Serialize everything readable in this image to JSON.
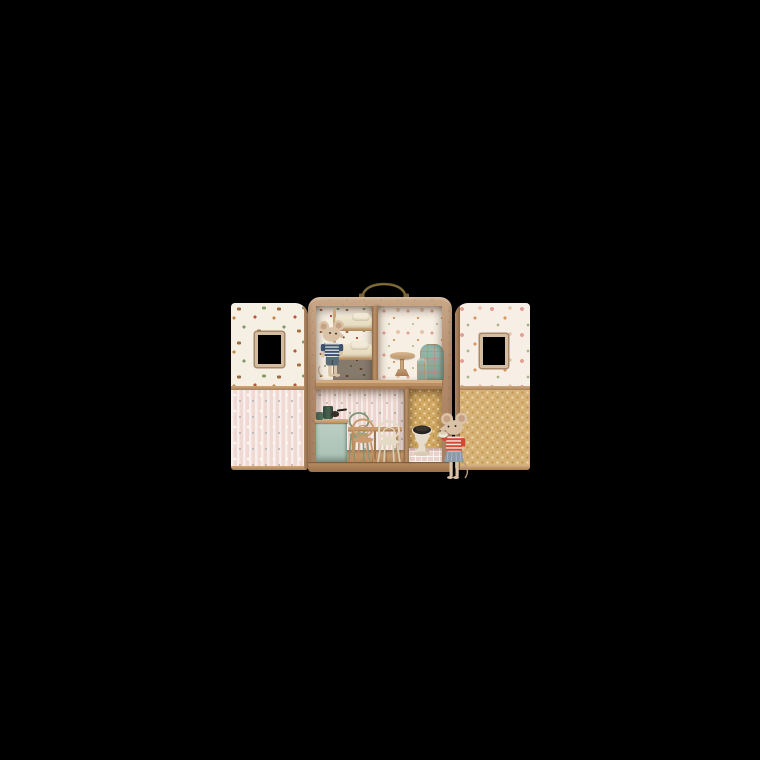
{
  "scene": {
    "description": "Product photograph of a toy mouse dollhouse built into an opened carry suitcase, shown on a plain black background. Two plush mice live in four wallpapered rooms furnished with miniature furniture.",
    "background_color": "#000000"
  },
  "product": {
    "name": "Mouse house suitcase dollhouse",
    "handle": "brass carry handle",
    "rooms": [
      {
        "name": "bedroom",
        "wallpaper": "cream western cowboy print",
        "furniture": [
          "bunk bed with cream mattresses and pillows"
        ],
        "occupant": "mouse in navy-and-white striped tee and blue-grey shorts"
      },
      {
        "name": "living-room",
        "wallpaper": "cream rose floral print",
        "furniture": [
          "round wooden pedestal table",
          "teal windowpane-check armchair"
        ]
      },
      {
        "name": "kitchen",
        "wallpaper": "pale pink pinstripe print",
        "furniture": [
          "mint kitchen cupboard with wooden counter",
          "dark green coffee pot",
          "green mug",
          "black pan",
          "wooden dining table",
          "green bentwood chair",
          "natural wood bentwood chair",
          "cream bentwood chair"
        ]
      },
      {
        "name": "bathroom",
        "wallpaper": "mustard damask print",
        "furniture": [
          "cream toilet with black seat",
          "pink tiled floor"
        ],
        "occupant": "mouse in red-and-white striped top and denim skirt holding a cream bowl"
      }
    ],
    "doors": [
      {
        "side": "left",
        "upper_wallpaper": "cream western cowboy print",
        "lower_wallpaper": "pink striped floral print",
        "window": "rectangular cut-out window with wooden frame"
      },
      {
        "side": "right",
        "upper_wallpaper": "cream rose floral print",
        "lower_wallpaper": "mustard damask print",
        "window": "rectangular cut-out window with wooden frame"
      }
    ]
  },
  "colors": {
    "bg": "#000000",
    "case_wood": "#b28a6a",
    "case_wood_light": "#c9a787",
    "case_wood_dark": "#99704a",
    "handle_brass": "#6d5b33",
    "wall_western": "#f5eee1",
    "wall_floral": "#f7efe3",
    "wall_stripe": "#edd6cf",
    "wall_mustard": "#d2a963",
    "door_pink": "#f0d9d3",
    "window_frame": "#d3bc9f",
    "floor_wood": "#cda577",
    "mint_cupboard": "#b5cabf",
    "pot_green": "#3d5344",
    "chair_green": "#7e9476",
    "chair_wood": "#c99b6d",
    "chair_cream": "#e4dbc4",
    "table_wood": "#c59a6e",
    "armchair_teal": "#8fb0a7",
    "check_line": "#c18954",
    "mouse_fur": "#d9c2a6",
    "ear_inner": "#c6a184",
    "tee_navy": "#3b5170",
    "shorts_blue": "#5a6a76",
    "top_red": "#d04a36",
    "skirt_denim": "#8b99a8",
    "bedding_cream": "#eae0c6",
    "toilet_cream": "#e7dcc9",
    "toilet_seat": "#27231f",
    "tile_pink": "#ead2ca"
  }
}
